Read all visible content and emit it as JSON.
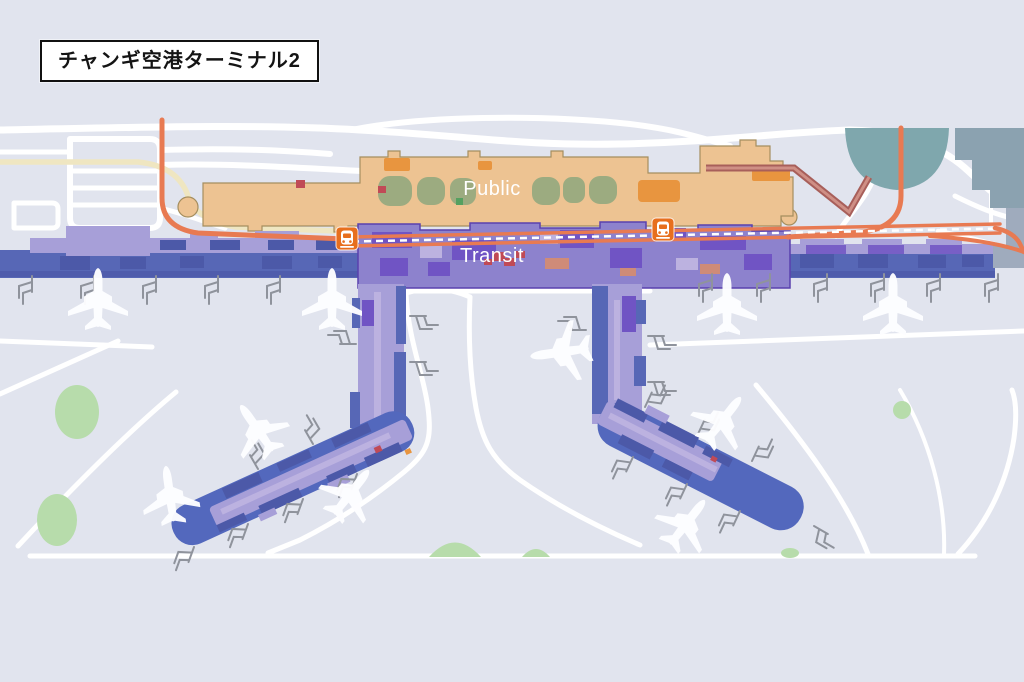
{
  "title": "チャンギ空港ターミナル2",
  "map": {
    "labels": {
      "public": "Public",
      "transit": "Transit"
    }
  },
  "icons": {
    "train_station": "train-front-pictogram",
    "airplane": "airplane-silhouette",
    "jet_bridge": "jet-bridge-comb",
    "tree": "tree-canopy-blob"
  },
  "colors": {
    "bg": "#e1e4ee",
    "road-white": "#ffffff",
    "road-cream": "#efe6c1",
    "road-orange": "#e87a52",
    "road-red-outer": "#a85f5a",
    "road-red-inner": "#cf8f85",
    "public-fill": "#edc392",
    "public-outline": "#a58e5f",
    "public-accent": "#e8953f",
    "olive": "#9cab80",
    "transit-main": "#8d82cd",
    "transit-dark": "#7054c4",
    "transit-outline": "#5a41ae",
    "transit-light": "#a79fd8",
    "lavender": "#bcb2e0",
    "apron-blue": "#5767b6",
    "apron-dark": "#4c59a8",
    "pier-blue": "#5368bd",
    "teal-1": "#7fa7ad",
    "teal-2": "#8ba2b0",
    "end-gray": "#9fabbd",
    "green": "#b7dcab",
    "green-dark": "#55a060",
    "red-dot": "#c04a56",
    "salmon": "#cf8b78",
    "jetbridge": "#8f939c",
    "plane": "#fdfdff",
    "train-orange": "#e76f1e",
    "title-text": "#141414",
    "title-border": "#111111"
  }
}
